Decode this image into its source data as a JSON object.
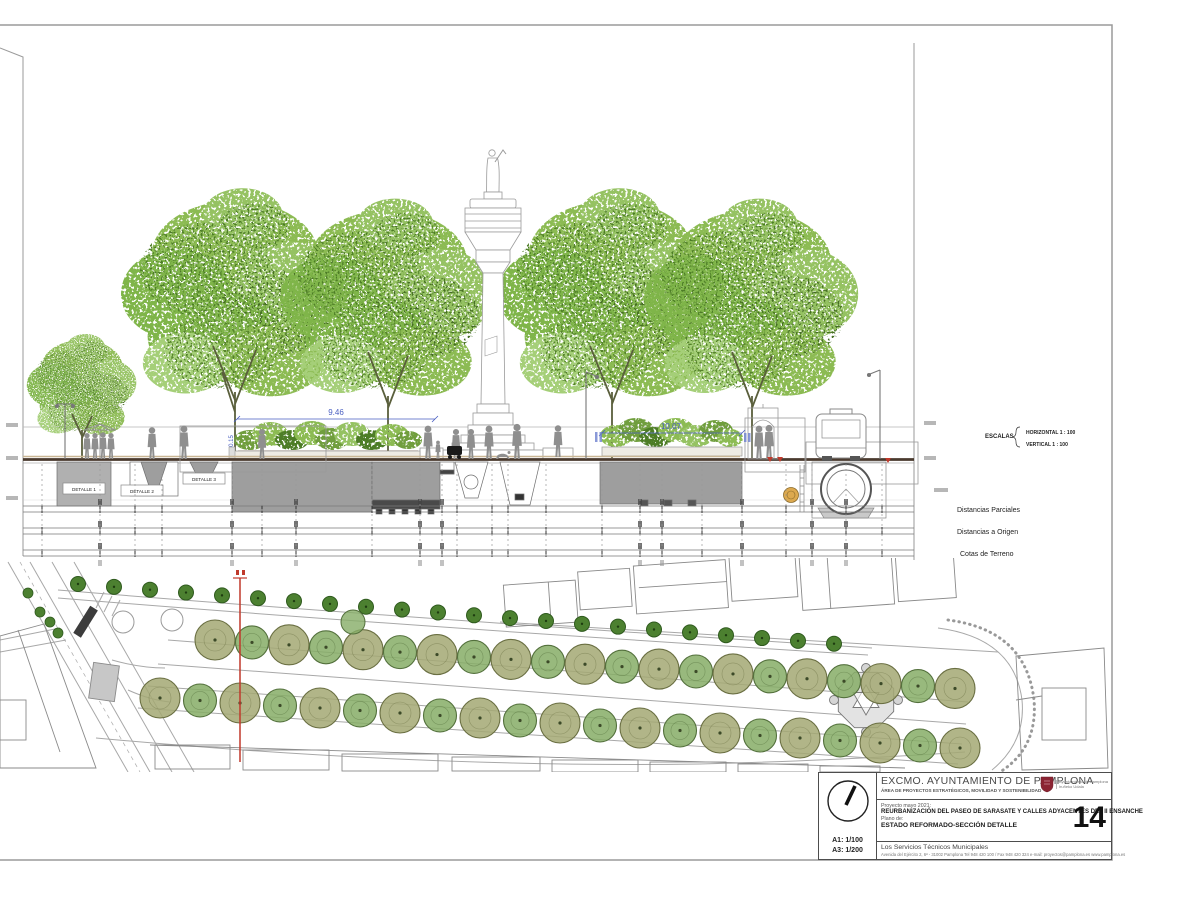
{
  "palette": {
    "accent_blue": "#4a5fc1",
    "section_cut_red": "#c0392b",
    "tree_green": "#7fb549",
    "tree_olive": "#a3a873",
    "logo_red": "#8b2433",
    "ground_brown": "#4a3a2e"
  },
  "section": {
    "detalle_labels": [
      "DETALLE 1",
      "DETALLE 2",
      "DETALLE 3"
    ],
    "dimensions": [
      "9.46",
      "0.15",
      "10.07"
    ],
    "escalas": {
      "title": "ESCALAS",
      "horizontal": "HORIZONTAL 1 : 100",
      "vertical": "VERTICAL 1 : 100"
    },
    "ruler_labels": [
      "Distancias Parciales",
      "Distancias a Origen",
      "Cotas de Terreno"
    ]
  },
  "title_block": {
    "org": "EXCMO. AYUNTAMIENTO DE PAMPLONA",
    "dept": "ÁREA DE PROYECTOS ESTRATÉGICOS, MOVILIDAD Y SOSTENIBILIDAD",
    "project_label": "Proyecto mayo 2021:",
    "project": "REURBANIZACIÓN DEL PASEO DE SARASATE Y CALLES ADYACENTES DEL II ENSANCHE",
    "plano_label": "Plano de:",
    "plano": "ESTADO REFORMADO-SECCIÓN DETALLE",
    "sheet_number": "14",
    "author": "Los Servicios Técnicos Municipales",
    "address": "Avenida del Ejército 2, 6ª - 31002 Pamplona Tel 948 420 100 / Fax 948 420 324 e-mail: proyectos@pamplona.es www.pamplona.es",
    "scale_a1": "A1: 1/100",
    "scale_a3": "A3: 1/200",
    "logo_left": "Ayuntamiento de Pamplona",
    "logo_right": "Iruñeko Udala"
  }
}
